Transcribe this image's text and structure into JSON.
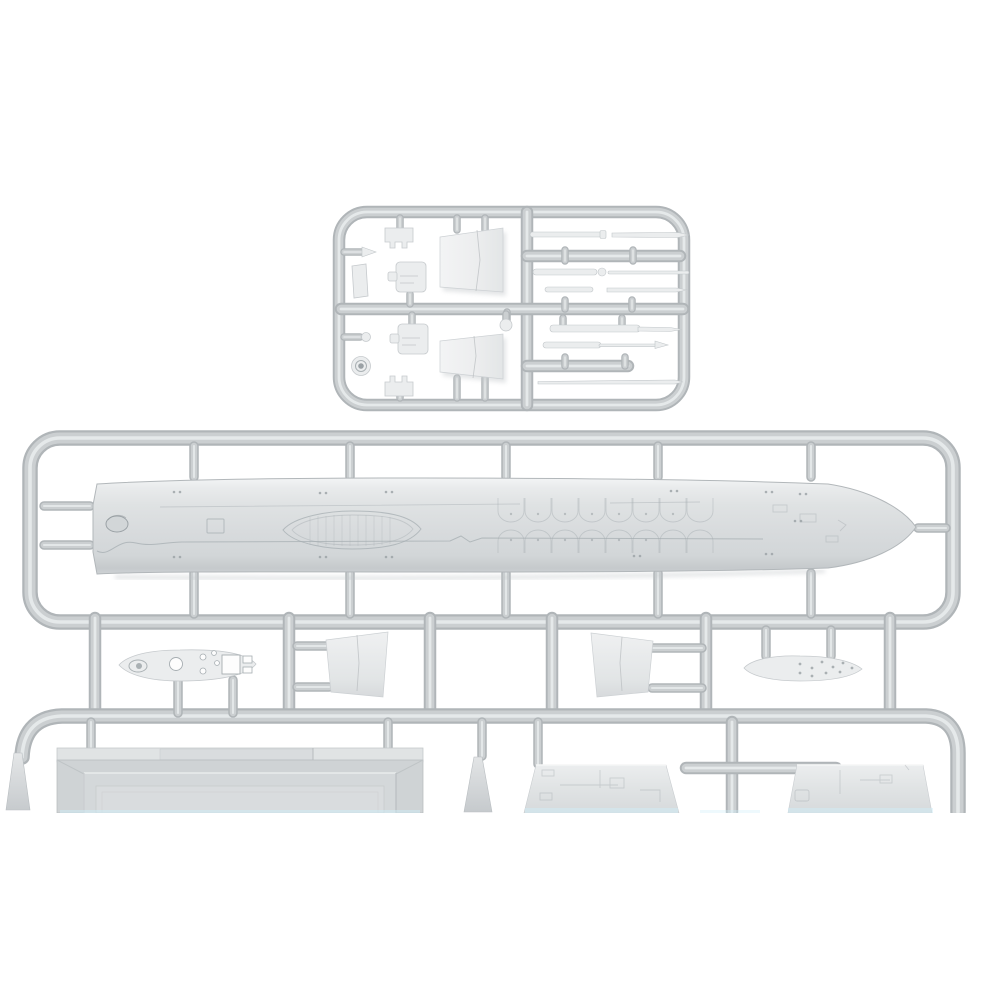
{
  "scene": {
    "description": "Product photograph of unpainted light-grey injection-moulded plastic model kit sprues for a small-scale warship: a small detail sprue at the top, a long runner frame holding the full-length ship hull in the middle, and partially visible lower sprues with deck, funnel and superstructure parts cropped by the bottom edge of the photo",
    "background_color": "#ffffff",
    "plastic_finish": "matte light grey styrene",
    "photo_cut_y_px": 813
  },
  "colors": {
    "tube_edge": "#b0b5b8",
    "tube_mid": "#cbcfd1",
    "tube_highlight": "#e8ebec",
    "part_fill": "#ebedee",
    "part_highlight": "#f7f8f8",
    "part_outline": "#c6cacd",
    "hull_mid": "#dcdfe0",
    "hull_shadow": "#c7cbce",
    "detail_line": "#a6adb1",
    "rivet_dot": "#9aa1a5",
    "scan_artifact_cyan": "#cfeef8"
  },
  "sprues": {
    "detail_sprue": {
      "label": "small detail sprue with superstructure parts and rod parts",
      "parts": [
        "notched bridge deck (x2)",
        "gun turret (x2)",
        "funnel side panel (x2)",
        "small superstructure block",
        "searchlight drum",
        "ball fitting",
        "mast and gun-barrel rods (x9)"
      ]
    },
    "hull_sprue": {
      "label": "main sprue with full-length ship hull half",
      "parts": [
        "ship hull half with engraved deck lens opening, hatch square, scalloped plating rows and rivet pairs"
      ],
      "connectors": "five feed stubs above and five below the hull, two side stubs at the stern, one gate at the bow tip"
    },
    "lower_sprues": {
      "label": "lower sprues cropped by the photo edge",
      "parts": [
        "perforated boat platform deck",
        "funnel casing half (x2)",
        "riveted ship's boat hull",
        "large bevelled deckhouse roof panel",
        "superstructure side panel (x2)",
        "tapered ventilator cone (x2)"
      ]
    }
  }
}
